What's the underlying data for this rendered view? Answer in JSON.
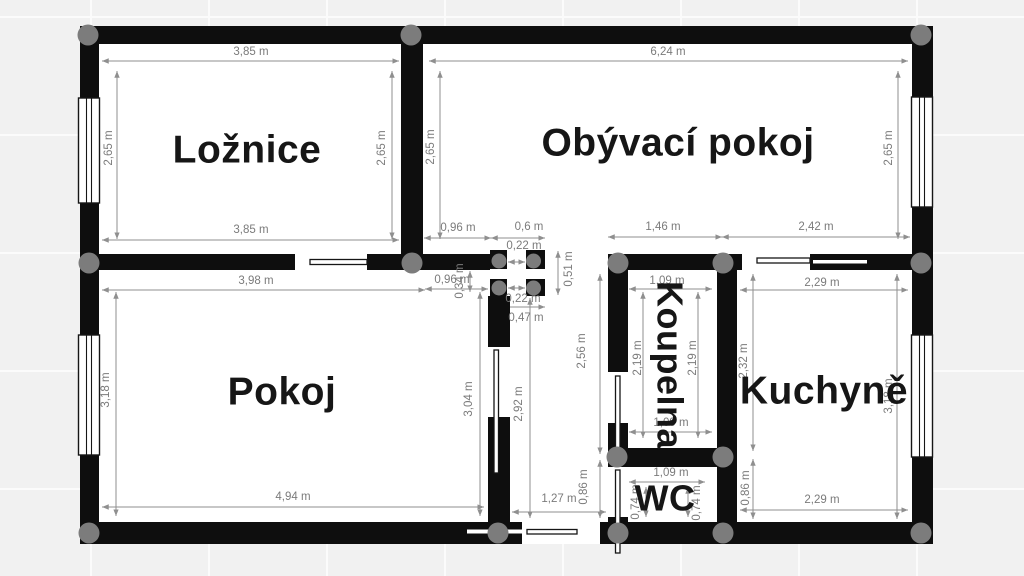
{
  "plan": {
    "rooms": {
      "loznice": "Ložnice",
      "obyvaci_pokoj": "Obývací pokoj",
      "pokoj": "Pokoj",
      "koupelna": "Koupelna",
      "wc": "WC",
      "kuchyne": "Kuchyně"
    },
    "dims": {
      "loznice_top": "3,85 m",
      "obyvaci_top": "6,24 m",
      "loznice_left": "2,65 m",
      "loznice_right": "2,65 m",
      "obyvaci_left": "2,65 m",
      "obyvaci_right": "2,65 m",
      "loznice_bottom": "3,85 m",
      "mid_096": "0,96 m",
      "mid_06": "0,6 m",
      "mid_146": "1,46 m",
      "mid_242": "2,42 m",
      "col_022_top": "0,22 m",
      "col_022_bottom": "0,22 m",
      "col_051": "0,51 m",
      "col_047": "0,47 m",
      "pokoj_top": "3,98 m",
      "pokoj_096": "0,96 m",
      "pokoj_034": "0,34 m",
      "pokoj_left": "3,18 m",
      "pokoj_right": "3,04 m",
      "pokoj_bottom": "4,94 m",
      "hall_292": "2,92 m",
      "hall_256": "2,56 m",
      "hall_086": "0,86 m",
      "hall_127": "1,27 m",
      "koupelna_top": "1,09 m",
      "koupelna_left": "2,19 m",
      "koupelna_right": "2,19 m",
      "koupelna_bottom": "1,09 m",
      "wc_top": "1,09 m",
      "wc_left": "0,74 m",
      "wc_right": "0,74 m",
      "kuchyne_left": "2,32 m",
      "kuchyne_086": "0,86 m",
      "kuchyne_top": "2,29 m",
      "kuchyne_bottom": "2,29 m",
      "kuchyne_right": "3,18 m"
    },
    "colors": {
      "wall": "#0e0e0e",
      "joint": "#7c7c7c",
      "dim_line": "#8f8f8f",
      "dim_text": "#7b7b7b",
      "room_label": "#161616",
      "floor": "#ffffff",
      "background": "#f1f1f1"
    }
  }
}
